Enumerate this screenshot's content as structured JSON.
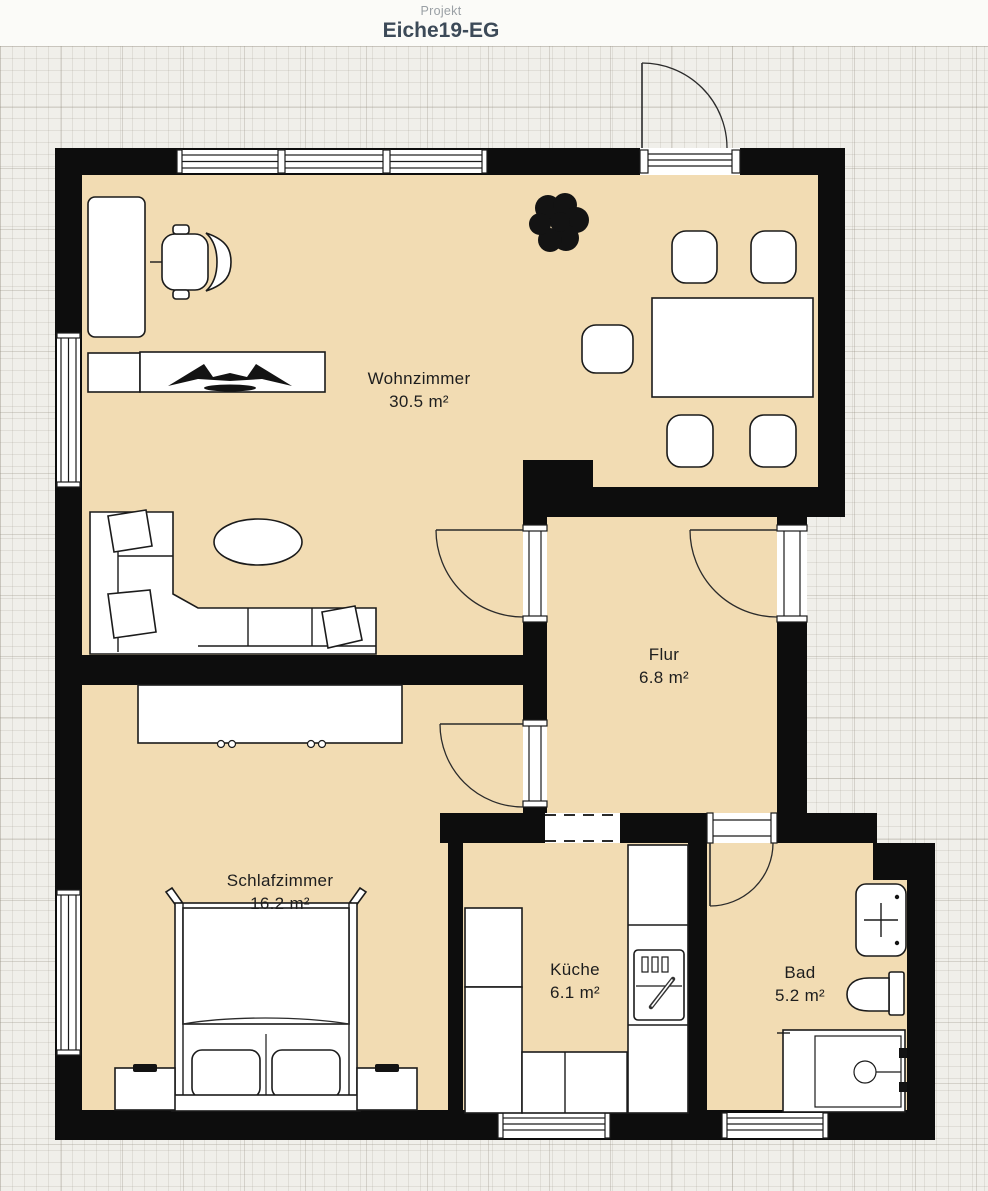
{
  "header": {
    "label": "Projekt",
    "title": "Eiche19-EG"
  },
  "rooms": [
    {
      "id": "wohnzimmer",
      "name": "Wohnzimmer",
      "area": "30.5 m²"
    },
    {
      "id": "flur",
      "name": "Flur",
      "area": "6.8 m²"
    },
    {
      "id": "schlafzimmer",
      "name": "Schlafzimmer",
      "area": "16.2 m²"
    },
    {
      "id": "kueche",
      "name": "Küche",
      "area": "6.1 m²"
    },
    {
      "id": "bad",
      "name": "Bad",
      "area": "5.2 m²"
    }
  ],
  "colors": {
    "room_fill": "#f2dcb3",
    "wall": "#0d0d0d",
    "canvas_bg": "#f0efea",
    "header_title": "#3c4a58",
    "header_label": "#9aa0a5"
  }
}
